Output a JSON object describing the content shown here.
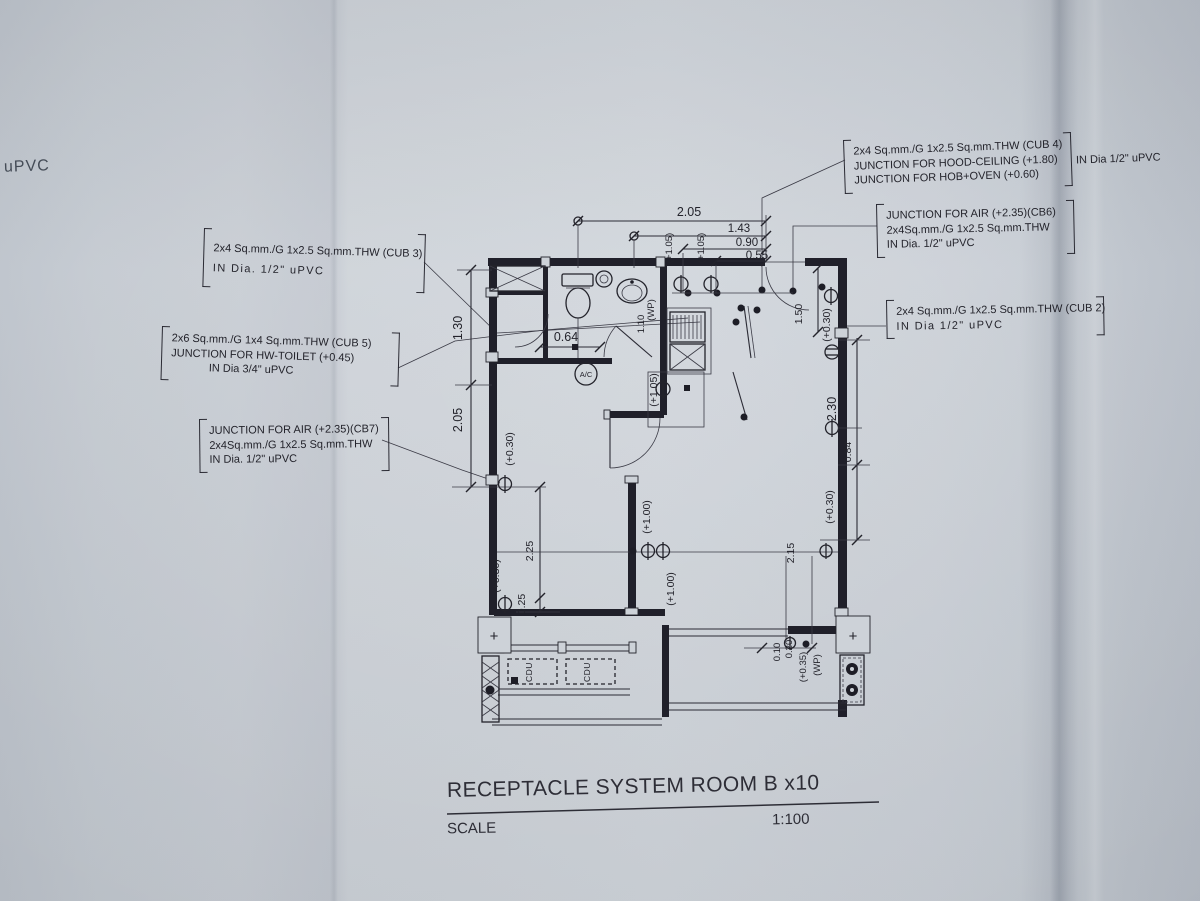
{
  "page": {
    "corner_text": "uPVC",
    "title": "RECEPTACLE SYSTEM  ROOM B x10",
    "scale_label": "SCALE",
    "scale_value": "1:100"
  },
  "annotations": {
    "cub4": {
      "lines": [
        "2x4 Sq.mm./G 1x2.5 Sq.mm.THW (CUB 4)",
        "JUNCTION FOR HOOD-CEILING (+1.80)",
        "JUNCTION FOR HOB+OVEN (+0.60)"
      ],
      "side": "IN Dia 1/2\" uPVC"
    },
    "cb6": {
      "lines": [
        "JUNCTION FOR AIR (+2.35)(CB6)",
        "2x4Sq.mm./G 1x2.5 Sq.mm.THW",
        "IN Dia. 1/2\" uPVC"
      ]
    },
    "cub2": {
      "lines": [
        "2x4 Sq.mm./G 1x2.5 Sq.mm.THW (CUB 2)",
        "IN Dia 1/2\" uPVC"
      ]
    },
    "cub3": {
      "lines": [
        "2x4 Sq.mm./G 1x2.5 Sq.mm.THW (CUB 3)",
        "IN Dia. 1/2\" uPVC"
      ]
    },
    "cub5": {
      "lines": [
        "2x6 Sq.mm./G 1x4 Sq.mm.THW (CUB 5)",
        "JUNCTION FOR HW-TOILET (+0.45)",
        "IN Dia 3/4\" uPVC"
      ]
    },
    "cb7": {
      "lines": [
        "JUNCTION FOR AIR (+2.35)(CB7)",
        "2x4Sq.mm./G 1x2.5 Sq.mm.THW",
        "IN Dia. 1/2\" uPVC"
      ]
    }
  },
  "labels": {
    "t205": "2.05",
    "t143": "1.43",
    "t090": "0.90",
    "t055": "0.55",
    "l130": "1.30",
    "l205": "2.05",
    "lp030a": "(+0.30)",
    "l225": "2.25",
    "lp030b": "(+0.30)",
    "l025": "0.25",
    "b064": "0.64",
    "ac": "A/C",
    "k105a": "(+1.05)",
    "k105b": "(+1.05)",
    "k105c": "(+1.05)",
    "k110": "1.10",
    "kwp": "(WP)",
    "m100a": "(+1.00)",
    "m100b": "(+1.00)",
    "m215": "2.15",
    "r230": "2.30",
    "r084": "0.84",
    "rp030a": "(+0.30)",
    "r150": "1.50",
    "rp030b": "(+0.30)",
    "br010": "0.10",
    "br020": "0.20",
    "brp035": "(+0.35)",
    "brwp": "(WP)",
    "cdu": "CDU",
    "plus": "+"
  },
  "colors": {
    "ink": "#23232b",
    "paper": "#c8cdd4",
    "walls": "#20202a"
  }
}
